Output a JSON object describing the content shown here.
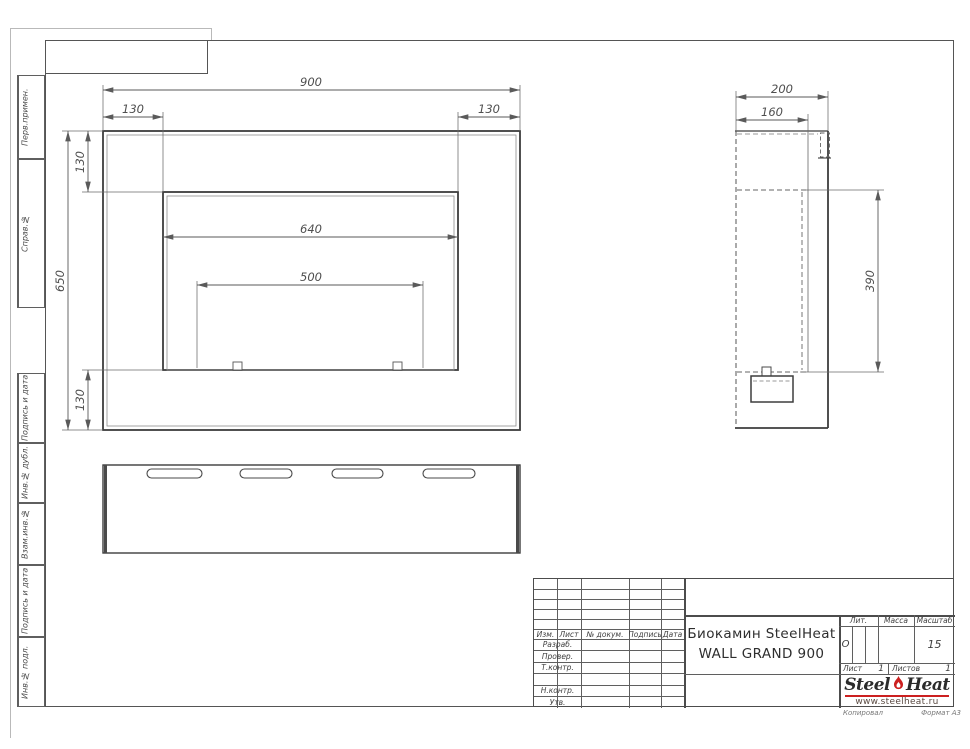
{
  "sheet": {
    "paper_notes": {
      "copied": "Копировал",
      "format": "Формат А3"
    }
  },
  "margin_labels": [
    "Перв.примен.",
    "Справ.№",
    "Подпись и дата",
    "Инв.№ дубл.",
    "Взам.инв.№",
    "Подпись и дата",
    "Инв.№ подл."
  ],
  "dimensions": {
    "front_view": {
      "overall_width": "900",
      "left_offset": "130",
      "right_offset": "130",
      "overall_height": "650",
      "top_offset": "130",
      "bottom_offset": "130",
      "opening_width": "640",
      "burner_width": "500"
    },
    "side_view": {
      "overall_depth": "200",
      "inner_depth": "160",
      "cavity_height": "390"
    }
  },
  "title_block": {
    "header_cols": [
      "Изм.",
      "Лист",
      "№ докум.",
      "Подпись",
      "Дата"
    ],
    "row_labels": [
      "Разраб.",
      "Провер.",
      "Т.контр.",
      "Н.контр.",
      "Утв."
    ],
    "doc_title_line1": "Биокамин SteelHeat",
    "doc_title_line2": "WALL GRAND 900",
    "lit_label": "Лит.",
    "lit_value": "О",
    "mass_label": "Масса",
    "scale_label": "Масштаб",
    "scale_value": "15",
    "sheet_label": "Лист",
    "sheet_value": "1",
    "sheets_label": "Листов",
    "sheets_value": "1",
    "logo": {
      "word1": "Steel",
      "word2": "Heat",
      "url": "www.steelheat.ru"
    },
    "colors": {
      "accent_red": "#cc2020",
      "line_gray": "#555555"
    }
  }
}
